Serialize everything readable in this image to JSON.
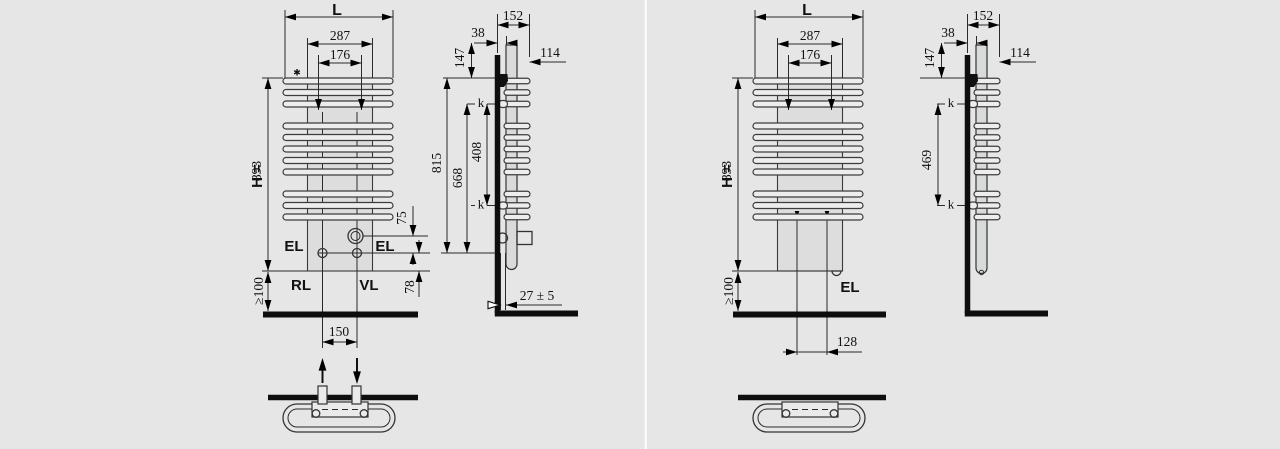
{
  "diagram": {
    "left": {
      "front": {
        "width": "L",
        "upper_width": "287",
        "conn_width": "176",
        "note_star": "✱",
        "height_prefix": "H =",
        "height_value": "893",
        "floor_clearance": "≥100",
        "el_left": "EL",
        "el_right": "EL",
        "return_label": "RL",
        "supply_label": "VL",
        "dim75": "75",
        "dim78": "78",
        "pipe_spacing": "150"
      },
      "side": {
        "depth": "152",
        "dim38": "38",
        "dim147": "147",
        "dim114": "114",
        "dim815": "815",
        "dim668": "668",
        "dim408": "408",
        "k_top": "k",
        "k_bottom": "k",
        "wall_gap": "27 ± 5"
      }
    },
    "right": {
      "front": {
        "width": "L",
        "upper_width": "287",
        "conn_width": "176",
        "height_prefix": "H =",
        "height_value": "893",
        "floor_clearance": "≥100",
        "el_label": "EL",
        "conn_offset": "128"
      },
      "side": {
        "depth": "152",
        "dim38": "38",
        "dim147": "147",
        "dim114": "114",
        "dim469": "469",
        "k_top": "k",
        "k_bottom": "k"
      }
    }
  }
}
